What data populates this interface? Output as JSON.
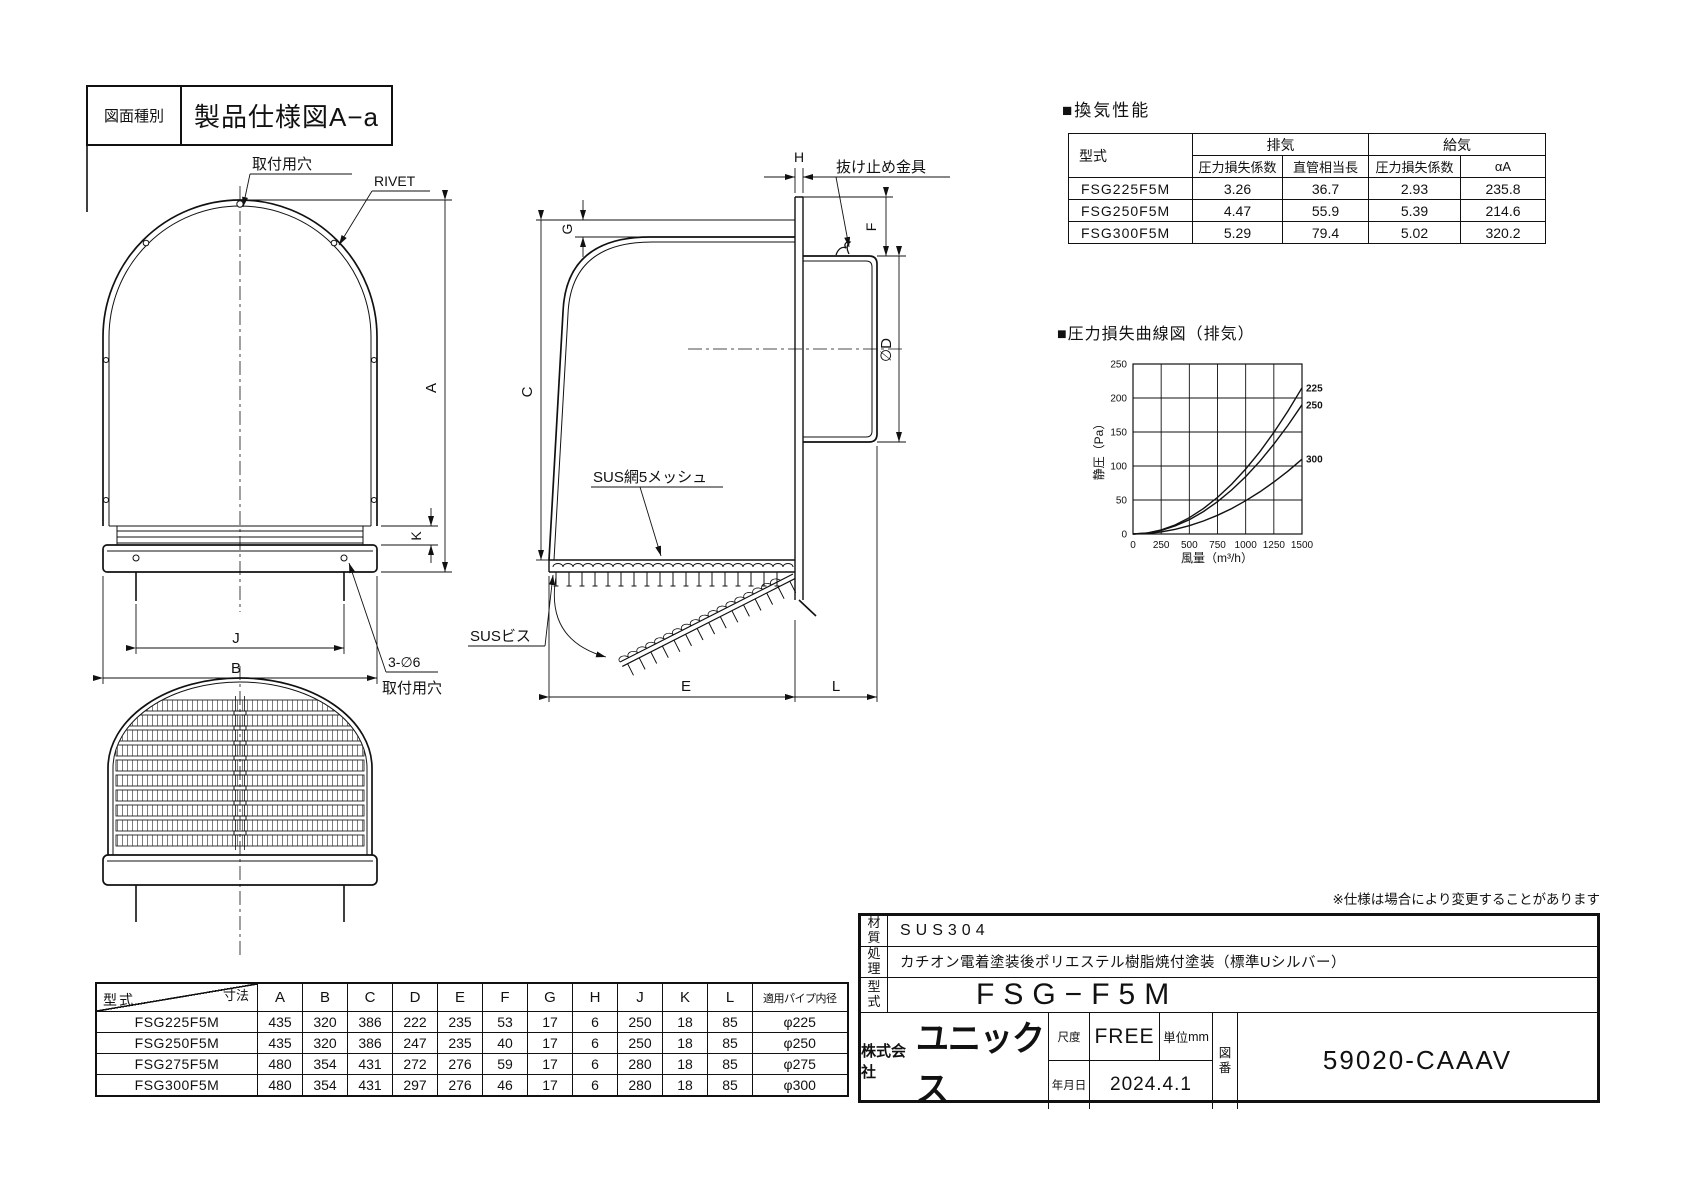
{
  "sheet": {
    "doc_type_label": "図面種別",
    "doc_type_value": "製品仕様図A−a",
    "note": "※仕様は場合により変更することがあります"
  },
  "performance": {
    "title": "■換気性能",
    "col_model": "型式",
    "col_exhaust": "排気",
    "col_supply": "給気",
    "sub_cols": [
      "圧力損失係数",
      "直管相当長",
      "圧力損失係数",
      "αA"
    ],
    "rows": [
      {
        "model": "FSG225F5M",
        "values": [
          "3.26",
          "36.7",
          "2.93",
          "235.8"
        ]
      },
      {
        "model": "FSG250F5M",
        "values": [
          "4.47",
          "55.9",
          "5.39",
          "214.6"
        ]
      },
      {
        "model": "FSG300F5M",
        "values": [
          "5.29",
          "79.4",
          "5.02",
          "320.2"
        ]
      }
    ]
  },
  "chart_data": {
    "type": "line",
    "title": "■圧力損失曲線図（排気）",
    "xlabel": "風量（m³/h）",
    "ylabel": "静圧（Pa）",
    "xlim": [
      0,
      1500
    ],
    "ylim": [
      0,
      250
    ],
    "xticks": [
      0,
      250,
      500,
      750,
      1000,
      1250,
      1500
    ],
    "yticks": [
      0,
      50,
      100,
      150,
      200,
      250
    ],
    "grid": true,
    "legend_position": "right-of-curve-ends",
    "x": [
      0,
      125,
      250,
      375,
      500,
      625,
      750,
      875,
      1000,
      1125,
      1250,
      1375,
      1500
    ],
    "series": [
      {
        "name": "225",
        "values": [
          0,
          1.5,
          6.0,
          13.4,
          23.9,
          37.3,
          53.8,
          73.2,
          95.6,
          120.9,
          149.3,
          180.7,
          215
        ]
      },
      {
        "name": "250",
        "values": [
          0,
          1.3,
          5.3,
          11.9,
          21.1,
          33.0,
          47.5,
          64.7,
          84.4,
          106.9,
          132.0,
          159.7,
          190
        ]
      },
      {
        "name": "300",
        "values": [
          0,
          0.8,
          3.1,
          6.9,
          12.2,
          19.1,
          27.5,
          37.4,
          48.9,
          61.9,
          76.4,
          92.4,
          110
        ]
      }
    ]
  },
  "dimension_table": {
    "corner_top": "寸法",
    "corner_bottom": "型式",
    "columns": [
      "A",
      "B",
      "C",
      "D",
      "E",
      "F",
      "G",
      "H",
      "J",
      "K",
      "L",
      "適用パイプ内径"
    ],
    "rows": [
      {
        "model": "FSG225F5M",
        "values": [
          "435",
          "320",
          "386",
          "222",
          "235",
          "53",
          "17",
          "6",
          "250",
          "18",
          "85",
          "φ225"
        ]
      },
      {
        "model": "FSG250F5M",
        "values": [
          "435",
          "320",
          "386",
          "247",
          "235",
          "40",
          "17",
          "6",
          "250",
          "18",
          "85",
          "φ250"
        ]
      },
      {
        "model": "FSG275F5M",
        "values": [
          "480",
          "354",
          "431",
          "272",
          "276",
          "59",
          "17",
          "6",
          "280",
          "18",
          "85",
          "φ275"
        ]
      },
      {
        "model": "FSG300F5M",
        "values": [
          "480",
          "354",
          "431",
          "297",
          "276",
          "46",
          "17",
          "6",
          "280",
          "18",
          "85",
          "φ300"
        ]
      }
    ]
  },
  "title_block": {
    "material_label": "材質",
    "material_value": "SUS304",
    "finish_label": "処理",
    "finish_value": "カチオン電着塗装後ポリエステル樹脂焼付塗装（標準Uシルバー）",
    "model_label": "型式",
    "model_value": "FSG−F5M",
    "company_prefix": "株式会社",
    "company_name": "ユニックス",
    "scale_label": "尺度",
    "scale_value": "FREE",
    "unit_label": "単位",
    "unit_value": "mm",
    "date_label": "年月日",
    "date_value": "2024.4.1",
    "drawing_no_label": "図番",
    "drawing_no_value": "59020-CAAAV"
  },
  "drawing_labels": {
    "mounting_hole_top": "取付用穴",
    "rivet": "RIVET",
    "three_phi6": "3-∅6",
    "mounting_hole_bottom": "取付用穴",
    "retainer_clip": "抜け止め金具",
    "mesh": "SUS網5メッシュ",
    "sus_screw": "SUSビス",
    "dims": {
      "A": "A",
      "B": "B",
      "C": "C",
      "D": "∅D",
      "E": "E",
      "F": "F",
      "G": "G",
      "H": "H",
      "J": "J",
      "K": "K",
      "L": "L"
    }
  }
}
